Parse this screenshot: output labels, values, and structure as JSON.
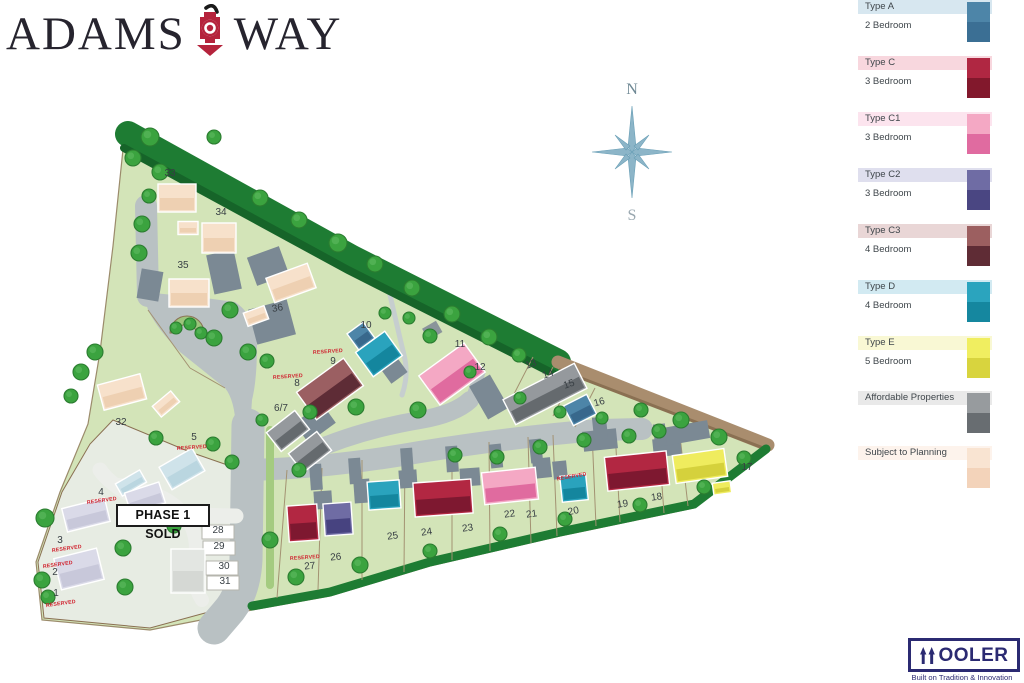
{
  "brand": {
    "word1": "ADAMS",
    "word2": "WAY",
    "icon_color": "#b5233c",
    "text_color": "#26242e"
  },
  "compass": {
    "north": "N",
    "south": "S"
  },
  "banner": {
    "text": "PHASE 1 SOLD"
  },
  "reserved_label": "RESERVED",
  "wooler": {
    "name_rest": "OOLER",
    "tagline": "Built on Tradition & Innovation",
    "color": "#2b2a72"
  },
  "legend": {
    "items": [
      {
        "label": "Type A",
        "sub": "2 Bedroom",
        "y": 0,
        "band": "#d7e7f0",
        "light": "#4d85a8",
        "dark": "#3b6f94"
      },
      {
        "label": "Type C",
        "sub": "3 Bedroom",
        "y": 56,
        "band": "#f8d7de",
        "light": "#b02742",
        "dark": "#82182c"
      },
      {
        "label": "Type C1",
        "sub": "3 Bedroom",
        "y": 112,
        "band": "#fce4ee",
        "light": "#f4a8c4",
        "dark": "#e06ba0"
      },
      {
        "label": "Type C2",
        "sub": "3 Bedroom",
        "y": 168,
        "band": "#dfdfee",
        "light": "#6f6ca4",
        "dark": "#4a4682"
      },
      {
        "label": "Type C3",
        "sub": "4 Bedroom",
        "y": 224,
        "band": "#e9d6d6",
        "light": "#9c5f60",
        "dark": "#5f2c35"
      },
      {
        "label": "Type D",
        "sub": "4 Bedroom",
        "y": 280,
        "band": "#d2eaf2",
        "light": "#2ba4be",
        "dark": "#15879f"
      },
      {
        "label": "Type E",
        "sub": "5 Bedroom",
        "y": 336,
        "band": "#f9f8d4",
        "light": "#f0ee60",
        "dark": "#d8d43e"
      },
      {
        "label": "Affordable Properties",
        "sub": "",
        "y": 391,
        "band": "#e9e9e9",
        "light": "#979b9e",
        "dark": "#686d71"
      },
      {
        "label": "Subject to Planning",
        "sub": "",
        "y": 446,
        "band": "#fdf3ec",
        "light": "#f9e4d2",
        "dark": "#f3d3ba"
      }
    ]
  },
  "map": {
    "palette": {
      "A": {
        "l": "#4d85a8",
        "d": "#38688c"
      },
      "C": {
        "l": "#b22742",
        "d": "#7e1830"
      },
      "C1": {
        "l": "#f4a8c4",
        "d": "#e06b9f"
      },
      "C2": {
        "l": "#6f6ca4",
        "d": "#474380"
      },
      "C3": {
        "l": "#9b5f62",
        "d": "#5e2c36"
      },
      "D": {
        "l": "#2aa3bd",
        "d": "#14869e"
      },
      "E": {
        "l": "#efec5e",
        "d": "#d5d13c"
      },
      "AF": {
        "l": "#95999d",
        "d": "#656a6e"
      },
      "STP": {
        "l": "#f7e1cb",
        "d": "#eed0b2"
      },
      "P1": {
        "l": "#dadae8",
        "d": "#c8c8da"
      },
      "P1B": {
        "l": "#cfe3ea",
        "d": "#bad6e0"
      },
      "P1G": {
        "l": "#e3e6e2",
        "d": "#d5d8d4"
      }
    },
    "houses": [
      [
        "STP",
        177,
        198,
        38,
        28,
        0
      ],
      [
        "STP",
        188,
        228,
        20,
        13,
        0
      ],
      [
        "STP",
        219,
        238,
        34,
        30,
        0
      ],
      [
        "STP",
        189,
        293,
        40,
        28,
        0
      ],
      [
        "STP",
        291,
        283,
        44,
        26,
        -20
      ],
      [
        "STP",
        256,
        316,
        22,
        14,
        -20
      ],
      [
        "STP",
        122,
        392,
        44,
        26,
        -15
      ],
      [
        "STP",
        166,
        404,
        24,
        14,
        -40
      ],
      [
        "AF",
        288,
        431,
        36,
        24,
        -38
      ],
      [
        "AF",
        310,
        452,
        36,
        24,
        -38
      ],
      [
        "AF",
        545,
        394,
        80,
        28,
        -27
      ],
      [
        "A",
        580,
        410,
        26,
        22,
        -27
      ],
      [
        "C3",
        330,
        389,
        58,
        34,
        -36
      ],
      [
        "A",
        361,
        336,
        20,
        20,
        -36
      ],
      [
        "D",
        379,
        354,
        36,
        30,
        -36
      ],
      [
        "C1",
        452,
        374,
        56,
        36,
        -36
      ],
      [
        "C",
        637,
        471,
        62,
        34,
        -6
      ],
      [
        "E",
        700,
        466,
        52,
        28,
        -8
      ],
      [
        "E",
        722,
        488,
        18,
        12,
        -8
      ],
      [
        "D",
        574,
        488,
        26,
        26,
        -6
      ],
      [
        "C1",
        510,
        486,
        54,
        32,
        -6
      ],
      [
        "C",
        443,
        498,
        58,
        34,
        -4
      ],
      [
        "D",
        384,
        495,
        32,
        28,
        -4
      ],
      [
        "C2",
        338,
        519,
        28,
        32,
        -4
      ],
      [
        "C",
        303,
        523,
        30,
        36,
        -4
      ],
      [
        "P1B",
        182,
        469,
        38,
        26,
        -30
      ],
      [
        "P1B",
        131,
        483,
        28,
        14,
        -30
      ],
      [
        "P1",
        145,
        498,
        36,
        22,
        -18
      ],
      [
        "P1",
        86,
        515,
        44,
        24,
        -14
      ],
      [
        "P1",
        79,
        569,
        44,
        32,
        -14
      ],
      [
        "P1G",
        188,
        571,
        34,
        44,
        0
      ]
    ],
    "trees": [
      [
        150,
        137,
        9
      ],
      [
        133,
        158,
        8
      ],
      [
        214,
        137,
        7
      ],
      [
        160,
        172,
        8
      ],
      [
        149,
        196,
        7
      ],
      [
        142,
        224,
        8
      ],
      [
        139,
        253,
        8
      ],
      [
        260,
        198,
        8
      ],
      [
        299,
        220,
        8
      ],
      [
        338,
        243,
        9
      ],
      [
        375,
        264,
        8
      ],
      [
        412,
        288,
        8
      ],
      [
        452,
        314,
        8
      ],
      [
        489,
        337,
        8
      ],
      [
        519,
        355,
        7
      ],
      [
        230,
        310,
        8
      ],
      [
        214,
        338,
        8
      ],
      [
        248,
        352,
        8
      ],
      [
        267,
        361,
        7
      ],
      [
        176,
        328,
        6
      ],
      [
        190,
        324,
        6
      ],
      [
        201,
        333,
        6
      ],
      [
        95,
        352,
        8
      ],
      [
        81,
        372,
        8
      ],
      [
        71,
        396,
        7
      ],
      [
        156,
        438,
        7
      ],
      [
        213,
        444,
        7
      ],
      [
        232,
        462,
        7
      ],
      [
        262,
        420,
        6
      ],
      [
        310,
        412,
        7
      ],
      [
        356,
        407,
        8
      ],
      [
        418,
        410,
        8
      ],
      [
        299,
        470,
        7
      ],
      [
        455,
        455,
        7
      ],
      [
        497,
        457,
        7
      ],
      [
        540,
        447,
        7
      ],
      [
        584,
        440,
        7
      ],
      [
        629,
        436,
        7
      ],
      [
        659,
        431,
        7
      ],
      [
        602,
        418,
        6
      ],
      [
        641,
        410,
        7
      ],
      [
        681,
        420,
        8
      ],
      [
        719,
        437,
        8
      ],
      [
        744,
        458,
        7
      ],
      [
        270,
        540,
        8
      ],
      [
        296,
        577,
        8
      ],
      [
        360,
        565,
        8
      ],
      [
        430,
        551,
        7
      ],
      [
        500,
        534,
        7
      ],
      [
        565,
        519,
        7
      ],
      [
        640,
        505,
        7
      ],
      [
        704,
        487,
        7
      ],
      [
        45,
        518,
        9
      ],
      [
        42,
        580,
        8
      ],
      [
        48,
        597,
        7
      ],
      [
        123,
        548,
        8
      ],
      [
        125,
        587,
        8
      ],
      [
        174,
        526,
        7
      ],
      [
        409,
        318,
        6
      ],
      [
        385,
        313,
        6
      ],
      [
        430,
        336,
        7
      ],
      [
        470,
        372,
        6
      ],
      [
        520,
        398,
        6
      ],
      [
        560,
        412,
        6
      ]
    ],
    "plots": [
      {
        "n": "33",
        "x": 170,
        "y": 176,
        "r": 0
      },
      {
        "n": "34",
        "x": 221,
        "y": 215,
        "r": 0
      },
      {
        "n": "35",
        "x": 183,
        "y": 268,
        "r": 0
      },
      {
        "n": "36",
        "x": 278,
        "y": 311,
        "r": -10
      },
      {
        "n": "32",
        "x": 121,
        "y": 425,
        "r": 0
      },
      {
        "n": "10",
        "x": 366,
        "y": 328,
        "r": 0
      },
      {
        "n": "9",
        "x": 333,
        "y": 364,
        "r": 0,
        "res": {
          "x": 328,
          "y": 353,
          "r": -4
        }
      },
      {
        "n": "8",
        "x": 297,
        "y": 386,
        "r": 0,
        "res": {
          "x": 288,
          "y": 378,
          "r": -4
        }
      },
      {
        "n": "6/7",
        "x": 281,
        "y": 411,
        "r": 0
      },
      {
        "n": "11",
        "x": 460,
        "y": 347,
        "r": 0
      },
      {
        "n": "12",
        "x": 480,
        "y": 370,
        "r": 0
      },
      {
        "n": "13",
        "x": 532,
        "y": 367,
        "r": -20
      },
      {
        "n": "14",
        "x": 549,
        "y": 377,
        "r": -20
      },
      {
        "n": "15",
        "x": 570,
        "y": 387,
        "r": -20
      },
      {
        "n": "16",
        "x": 600,
        "y": 405,
        "r": -15
      },
      {
        "n": "17",
        "x": 747,
        "y": 470,
        "r": 0
      },
      {
        "n": "18",
        "x": 657,
        "y": 500,
        "r": -8
      },
      {
        "n": "19",
        "x": 623,
        "y": 507,
        "r": -8
      },
      {
        "n": "20",
        "x": 574,
        "y": 514,
        "r": -12,
        "res": {
          "x": 572,
          "y": 478,
          "r": -10
        }
      },
      {
        "n": "21",
        "x": 532,
        "y": 517,
        "r": -8
      },
      {
        "n": "22",
        "x": 510,
        "y": 517,
        "r": -8
      },
      {
        "n": "23",
        "x": 468,
        "y": 531,
        "r": -8
      },
      {
        "n": "24",
        "x": 427,
        "y": 535,
        "r": -8
      },
      {
        "n": "25",
        "x": 393,
        "y": 539,
        "r": -8
      },
      {
        "n": "26",
        "x": 336,
        "y": 560,
        "r": -5
      },
      {
        "n": "27",
        "x": 310,
        "y": 569,
        "r": -5,
        "res": {
          "x": 305,
          "y": 559,
          "r": -4
        }
      },
      {
        "n": "28",
        "x": 218,
        "y": 533,
        "r": 0
      },
      {
        "n": "29",
        "x": 219,
        "y": 549,
        "r": 0
      },
      {
        "n": "30",
        "x": 224,
        "y": 569,
        "r": 0
      },
      {
        "n": "31",
        "x": 225,
        "y": 584,
        "r": 0
      },
      {
        "n": "5",
        "x": 194,
        "y": 440,
        "r": 0,
        "res": {
          "x": 192,
          "y": 449,
          "r": -4
        }
      },
      {
        "n": "4",
        "x": 101,
        "y": 495,
        "r": 0,
        "res": {
          "x": 102,
          "y": 502,
          "r": -8
        }
      },
      {
        "n": "3",
        "x": 60,
        "y": 543,
        "r": 0,
        "res": {
          "x": 67,
          "y": 550,
          "r": -8
        }
      },
      {
        "n": "2",
        "x": 55,
        "y": 575,
        "r": 0,
        "res": {
          "x": 58,
          "y": 566,
          "r": -8
        }
      },
      {
        "n": "1",
        "x": 56,
        "y": 596,
        "r": 0,
        "res": {
          "x": 61,
          "y": 605,
          "r": -8
        }
      }
    ]
  }
}
